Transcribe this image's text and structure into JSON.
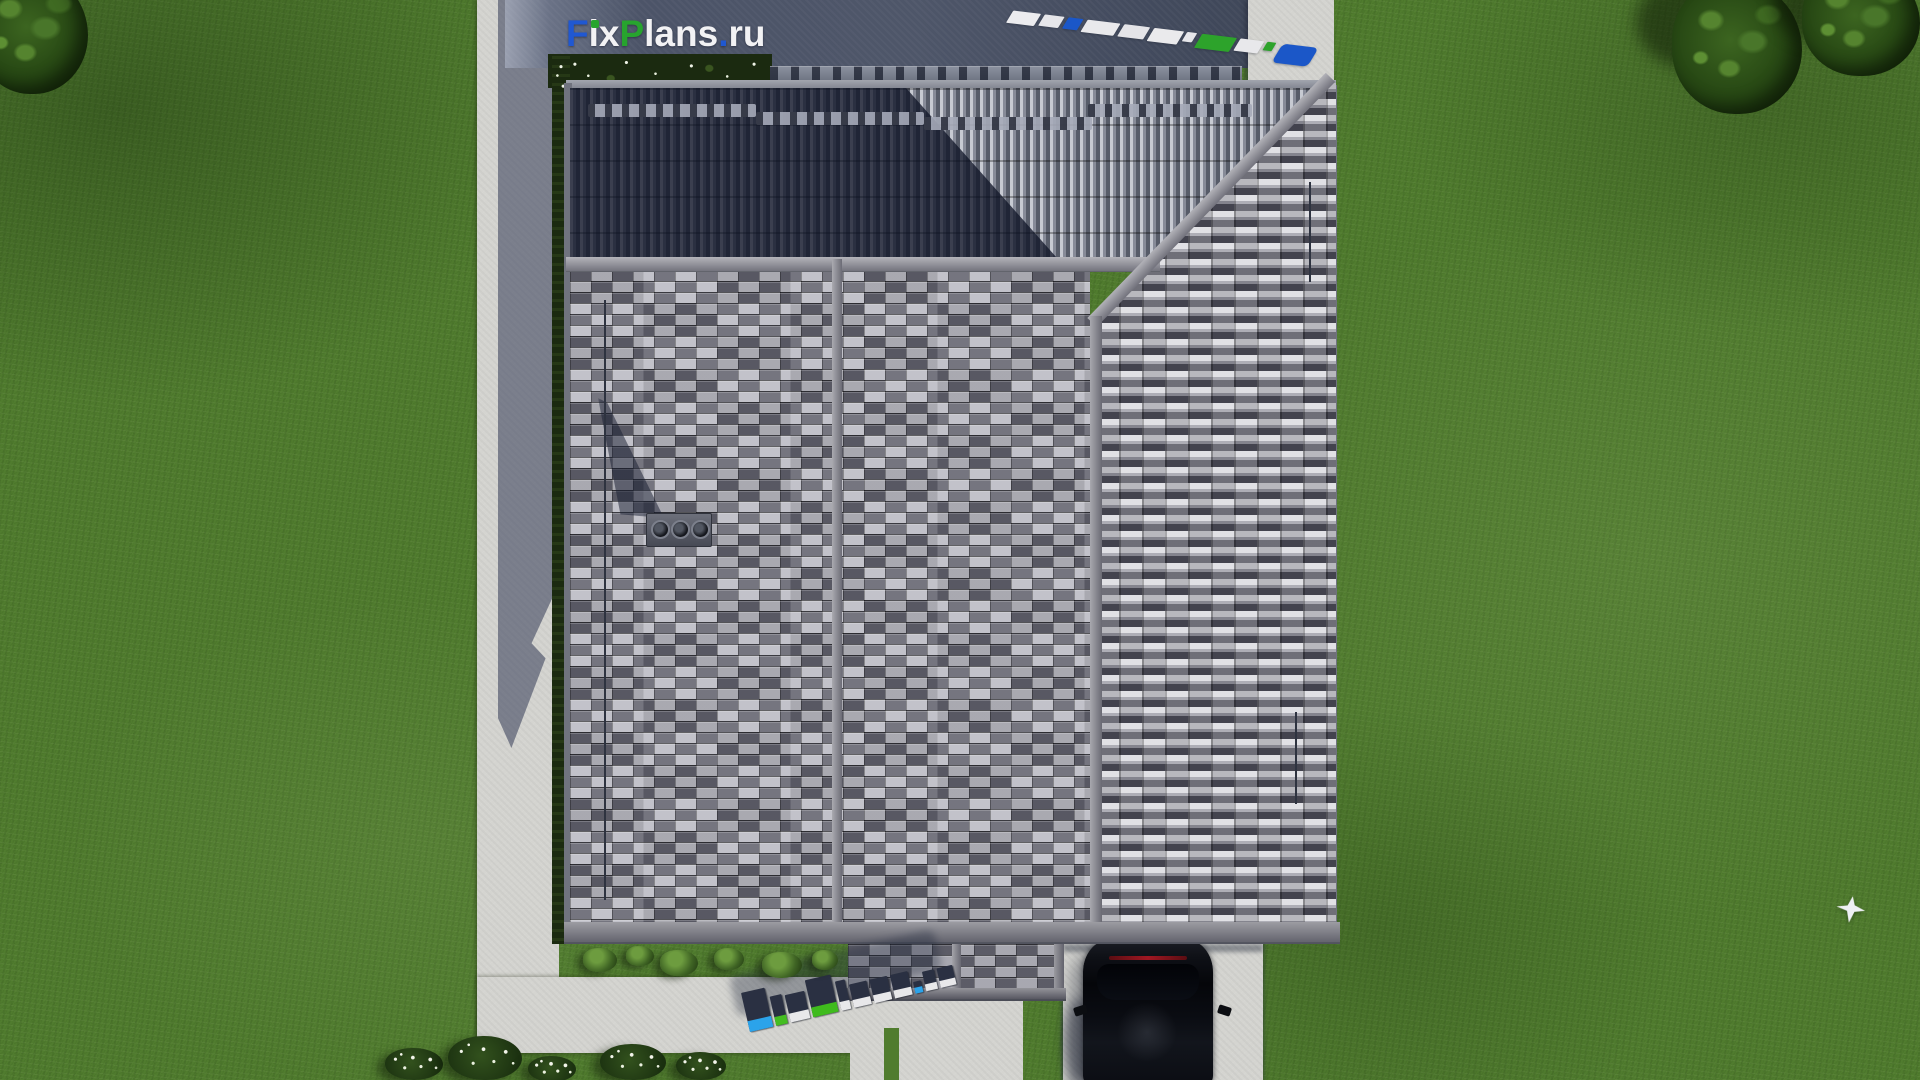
{
  "site": {
    "name": "FixPlans.ru",
    "logo": {
      "segments": [
        {
          "text": "F",
          "color": "#2058d2"
        },
        {
          "text": "i",
          "color": "#f2f2f4",
          "idot": "#27a42e"
        },
        {
          "text": "x",
          "color": "#f2f2f4"
        },
        {
          "text": "P",
          "color": "#27a42e"
        },
        {
          "text": "lans",
          "color": "#f2f2f4"
        },
        {
          "text": ".",
          "color": "#2058d2"
        },
        {
          "text": "ru",
          "color": "#f2f2f4"
        }
      ]
    }
  },
  "palette": {
    "grass": "#507c2e",
    "concrete": "#d4d4d0",
    "courtyard_dark": "#4c5468",
    "roof_tile_light": "#c6c6ca",
    "roof_tile_mid": "#8a8a92",
    "roof_tile_dark": "#3c3c44",
    "roof_band": "#8f8f97",
    "shadow_navy": "#141c30",
    "logo_blue": "#2058d2",
    "logo_green": "#27a42e",
    "logo_white": "#f2f2f4",
    "car_black": "#0a0c12",
    "brake_light_red": "#a01722"
  },
  "ground_logo_3d": {
    "text": "FixPlans.ru",
    "top_color": "#2a3042",
    "letters": [
      {
        "w": 24,
        "h": 40,
        "f": 11,
        "face": "#2ba3ea"
      },
      {
        "w": 12,
        "h": 30,
        "f": 9,
        "face": "#44bd21"
      },
      {
        "w": 20,
        "h": 28,
        "f": 9,
        "face": "#e8e8ea"
      },
      {
        "w": 26,
        "h": 38,
        "f": 10,
        "face": "#3fbb1d"
      },
      {
        "w": 10,
        "h": 30,
        "f": 9,
        "face": "#e8e8ea"
      },
      {
        "w": 18,
        "h": 24,
        "f": 8,
        "face": "#e8e8ea"
      },
      {
        "w": 18,
        "h": 24,
        "f": 8,
        "face": "#e8e8ea"
      },
      {
        "w": 18,
        "h": 24,
        "f": 8,
        "face": "#e8e8ea"
      },
      {
        "w": 8,
        "h": 12,
        "f": 6,
        "face": "#2ba3ea"
      },
      {
        "w": 12,
        "h": 20,
        "f": 7,
        "face": "#e8e8ea"
      },
      {
        "w": 16,
        "h": 20,
        "f": 7,
        "face": "#e8e8ea"
      }
    ]
  },
  "ground_watermark_top_right": {
    "text": "FixPlans.ru",
    "blocks": [
      {
        "w": 28,
        "h": 13,
        "c": "#ececef"
      },
      {
        "w": 20,
        "h": 12,
        "c": "#e6e6ea"
      },
      {
        "w": 15,
        "h": 12,
        "c": "#1b57c8"
      },
      {
        "w": 33,
        "h": 13,
        "c": "#e9e9ec"
      },
      {
        "w": 26,
        "h": 13,
        "c": "#e4e4e8"
      },
      {
        "w": 30,
        "h": 14,
        "c": "#eaeaec"
      },
      {
        "w": 10,
        "h": 10,
        "c": "#e6e6ea"
      },
      {
        "w": 35,
        "h": 15,
        "c": "#2da32b"
      },
      {
        "w": 24,
        "h": 13,
        "c": "#e8e8eb"
      },
      {
        "w": 9,
        "h": 9,
        "c": "#2da32b"
      },
      {
        "w": 36,
        "h": 20,
        "c": "#1b57c8",
        "r": 5
      }
    ]
  },
  "landscape": {
    "shrubs": [
      {
        "x": 583,
        "y": 948,
        "w": 34,
        "h": 24
      },
      {
        "x": 626,
        "y": 946,
        "w": 28,
        "h": 20
      },
      {
        "x": 660,
        "y": 950,
        "w": 38,
        "h": 26
      },
      {
        "x": 714,
        "y": 948,
        "w": 30,
        "h": 22
      },
      {
        "x": 762,
        "y": 952,
        "w": 40,
        "h": 26
      },
      {
        "x": 812,
        "y": 950,
        "w": 26,
        "h": 20
      }
    ],
    "flower_bushes": [
      {
        "x": 385,
        "y": 1048,
        "w": 58,
        "h": 32
      },
      {
        "x": 448,
        "y": 1036,
        "w": 74,
        "h": 44
      },
      {
        "x": 528,
        "y": 1056,
        "w": 48,
        "h": 26
      },
      {
        "x": 600,
        "y": 1044,
        "w": 66,
        "h": 36
      },
      {
        "x": 676,
        "y": 1052,
        "w": 50,
        "h": 28
      }
    ]
  }
}
